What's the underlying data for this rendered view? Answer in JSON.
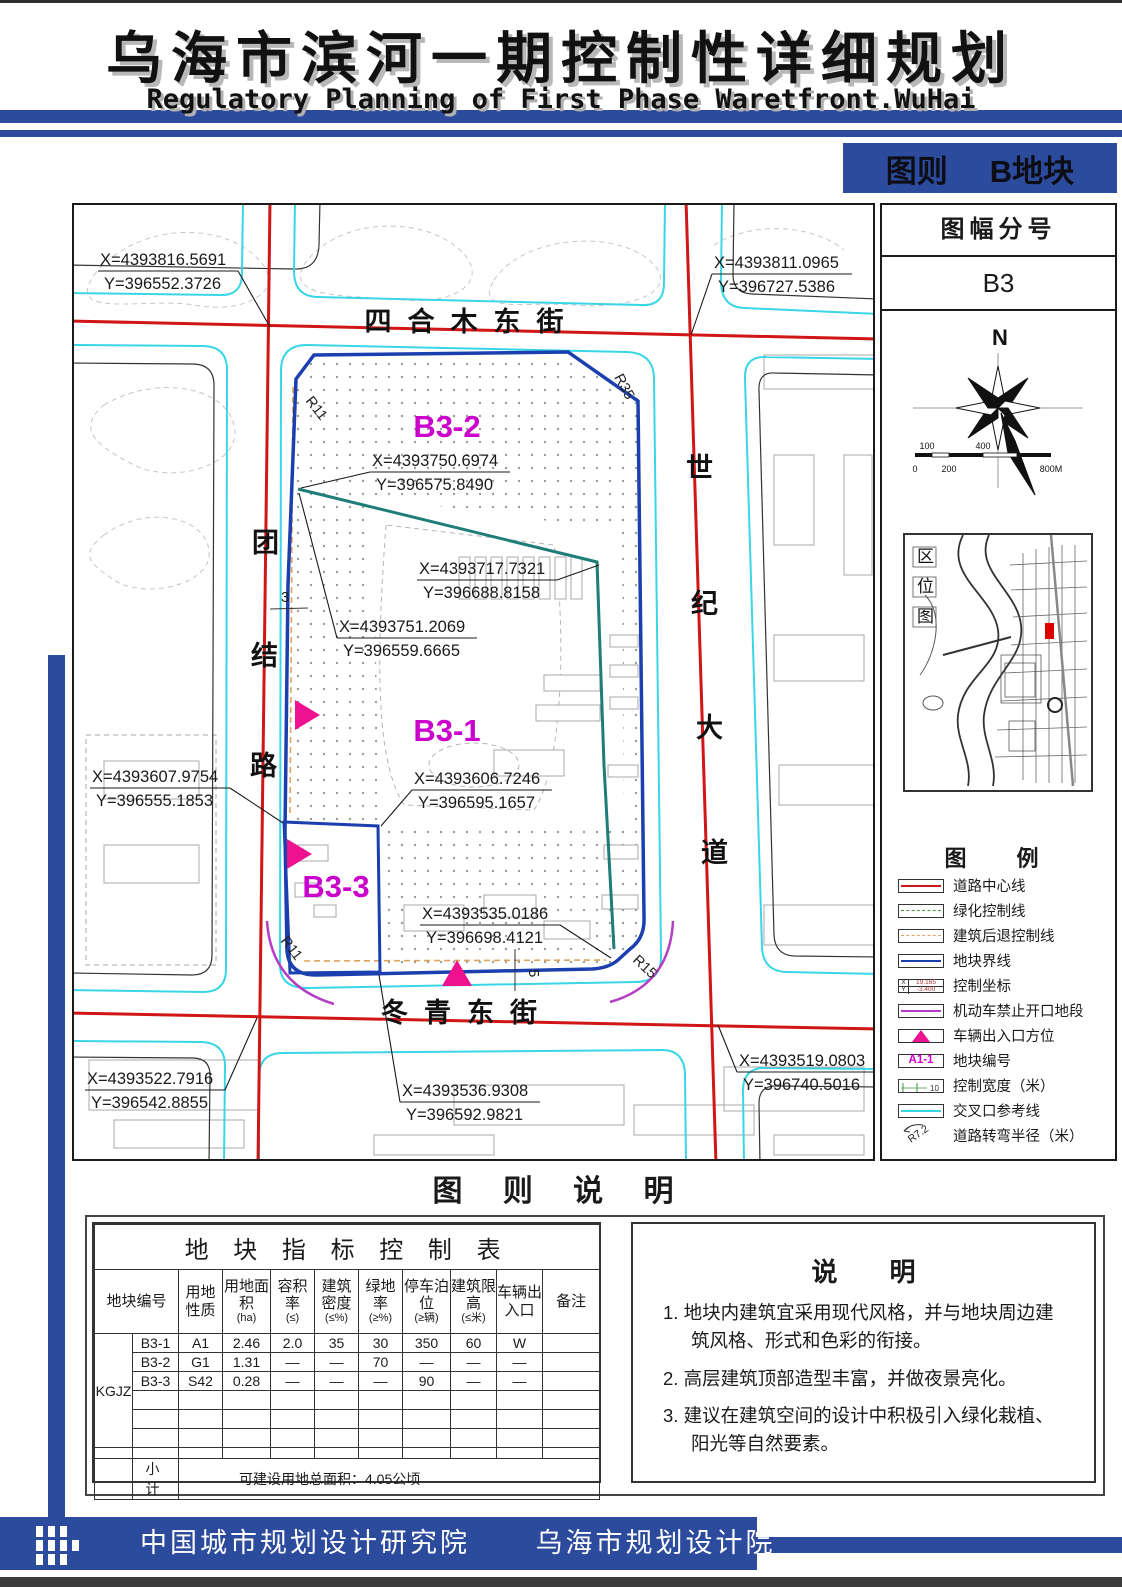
{
  "page": {
    "title": "乌海市滨河一期控制性详细规划",
    "subtitle": "Regulatory Planning of First Phase Waretfront.WuHai"
  },
  "badge": {
    "left": "图则",
    "right": "B地块"
  },
  "sheet_panel": {
    "title": "图幅分号",
    "number": "B3",
    "north": "N",
    "scale": {
      "top": [
        "100",
        "400"
      ],
      "bottom": [
        "0",
        "200",
        "800M"
      ]
    }
  },
  "location_panel": {
    "chars": [
      "区",
      "位",
      "图"
    ]
  },
  "legend": {
    "title": "图　例",
    "items": [
      "道路中心线",
      "绿化控制线",
      "建筑后退控制线",
      "地块界线",
      "控制坐标",
      "机动车禁止开口地段",
      "车辆出入口方位",
      "地块编号",
      "控制宽度（米）",
      "交叉口参考线",
      "道路转弯半径（米）"
    ],
    "coord_sample": {
      "x_label": "X",
      "x_value": "19.165",
      "y_label": "Y",
      "y_value": "-3.400"
    },
    "parcel_sample": "A1-1",
    "width_sample": "10",
    "radius_sample": "R7.2"
  },
  "map": {
    "streets": {
      "north": "四合木东街",
      "south": "冬青东街",
      "west": [
        "团",
        "结",
        "路"
      ],
      "east": [
        "世",
        "纪",
        "大",
        "道"
      ]
    },
    "parcels": {
      "b31": "B3-1",
      "b32": "B3-2",
      "b33": "B3-3"
    },
    "radius": {
      "top_left": "R11",
      "top_right": "R35",
      "bottom_left": "R11",
      "bottom_right": "R15"
    },
    "dims": {
      "width3": "3",
      "width5": "5"
    },
    "coords": [
      {
        "x": "X=4393816.5691",
        "y": "Y=396552.3726"
      },
      {
        "x": "X=4393811.0965",
        "y": "Y=396727.5386"
      },
      {
        "x": "X=4393750.6974",
        "y": "Y=396575.8490"
      },
      {
        "x": "X=4393717.7321",
        "y": "Y=396688.8158"
      },
      {
        "x": "X=4393751.2069",
        "y": "Y=396559.6665"
      },
      {
        "x": "X=4393607.9754",
        "y": "Y=396555.1853"
      },
      {
        "x": "X=4393606.7246",
        "y": "Y=396595.1657"
      },
      {
        "x": "X=4393535.0186",
        "y": "Y=396698.4121"
      },
      {
        "x": "X=4393522.7916",
        "y": "Y=396542.8855"
      },
      {
        "x": "X=4393536.9308",
        "y": "Y=396592.9821"
      },
      {
        "x": "X=4393519.0803",
        "y": "Y=396740.5016"
      }
    ]
  },
  "section_title": "图 则 说 明",
  "table": {
    "title": "地 块 指 标 控 制 表",
    "headers": [
      {
        "name": "地块编号",
        "unit": ""
      },
      {
        "name": "用地性质",
        "unit": ""
      },
      {
        "name": "用地面积",
        "unit": "(ha)"
      },
      {
        "name": "容积率",
        "unit": "(≤)"
      },
      {
        "name": "建筑密度",
        "unit": "(≤%)"
      },
      {
        "name": "绿地率",
        "unit": "(≥%)"
      },
      {
        "name": "停车泊位",
        "unit": "(≥辆)"
      },
      {
        "name": "建筑限高",
        "unit": "(≤米)"
      },
      {
        "name": "车辆出入口",
        "unit": ""
      },
      {
        "name": "备注",
        "unit": ""
      }
    ],
    "group_label": "KGJZ",
    "rows": [
      {
        "c": [
          "B3-1",
          "A1",
          "2.46",
          "2.0",
          "35",
          "30",
          "350",
          "60",
          "W",
          ""
        ]
      },
      {
        "c": [
          "B3-2",
          "G1",
          "1.31",
          "—",
          "—",
          "70",
          "—",
          "—",
          "—",
          ""
        ]
      },
      {
        "c": [
          "B3-3",
          "S42",
          "0.28",
          "—",
          "—",
          "—",
          "90",
          "—",
          "—",
          ""
        ]
      }
    ],
    "subtotal_label": "小　计",
    "subtotal_value": "可建设用地总面积：4.05公顷"
  },
  "notes": {
    "title": "说　　明",
    "items": [
      "1. 地块内建筑宜采用现代风格，并与地块周边建筑风格、形式和色彩的衔接。",
      "2. 高层建筑顶部造型丰富，并做夜景亮化。",
      "3. 建议在建筑空间的设计中积极引入绿化栽植、阳光等自然要素。"
    ]
  },
  "footer": {
    "org1": "中国城市规划设计研究院",
    "org2": "乌海市规划设计院"
  },
  "colors": {
    "accent_blue": "#2c4b9c",
    "road_red": "#d01616",
    "reference_cyan": "#38d6e6",
    "parcel_blue": "#1b3fae",
    "block_teal": "#1e7d77",
    "entry_magenta": "#ee1190",
    "no_open_violet": "#b43fc4",
    "setback_orange": "#dfa35c",
    "label_magenta": "#cc00cc",
    "highlight_red": "#dd0000"
  }
}
